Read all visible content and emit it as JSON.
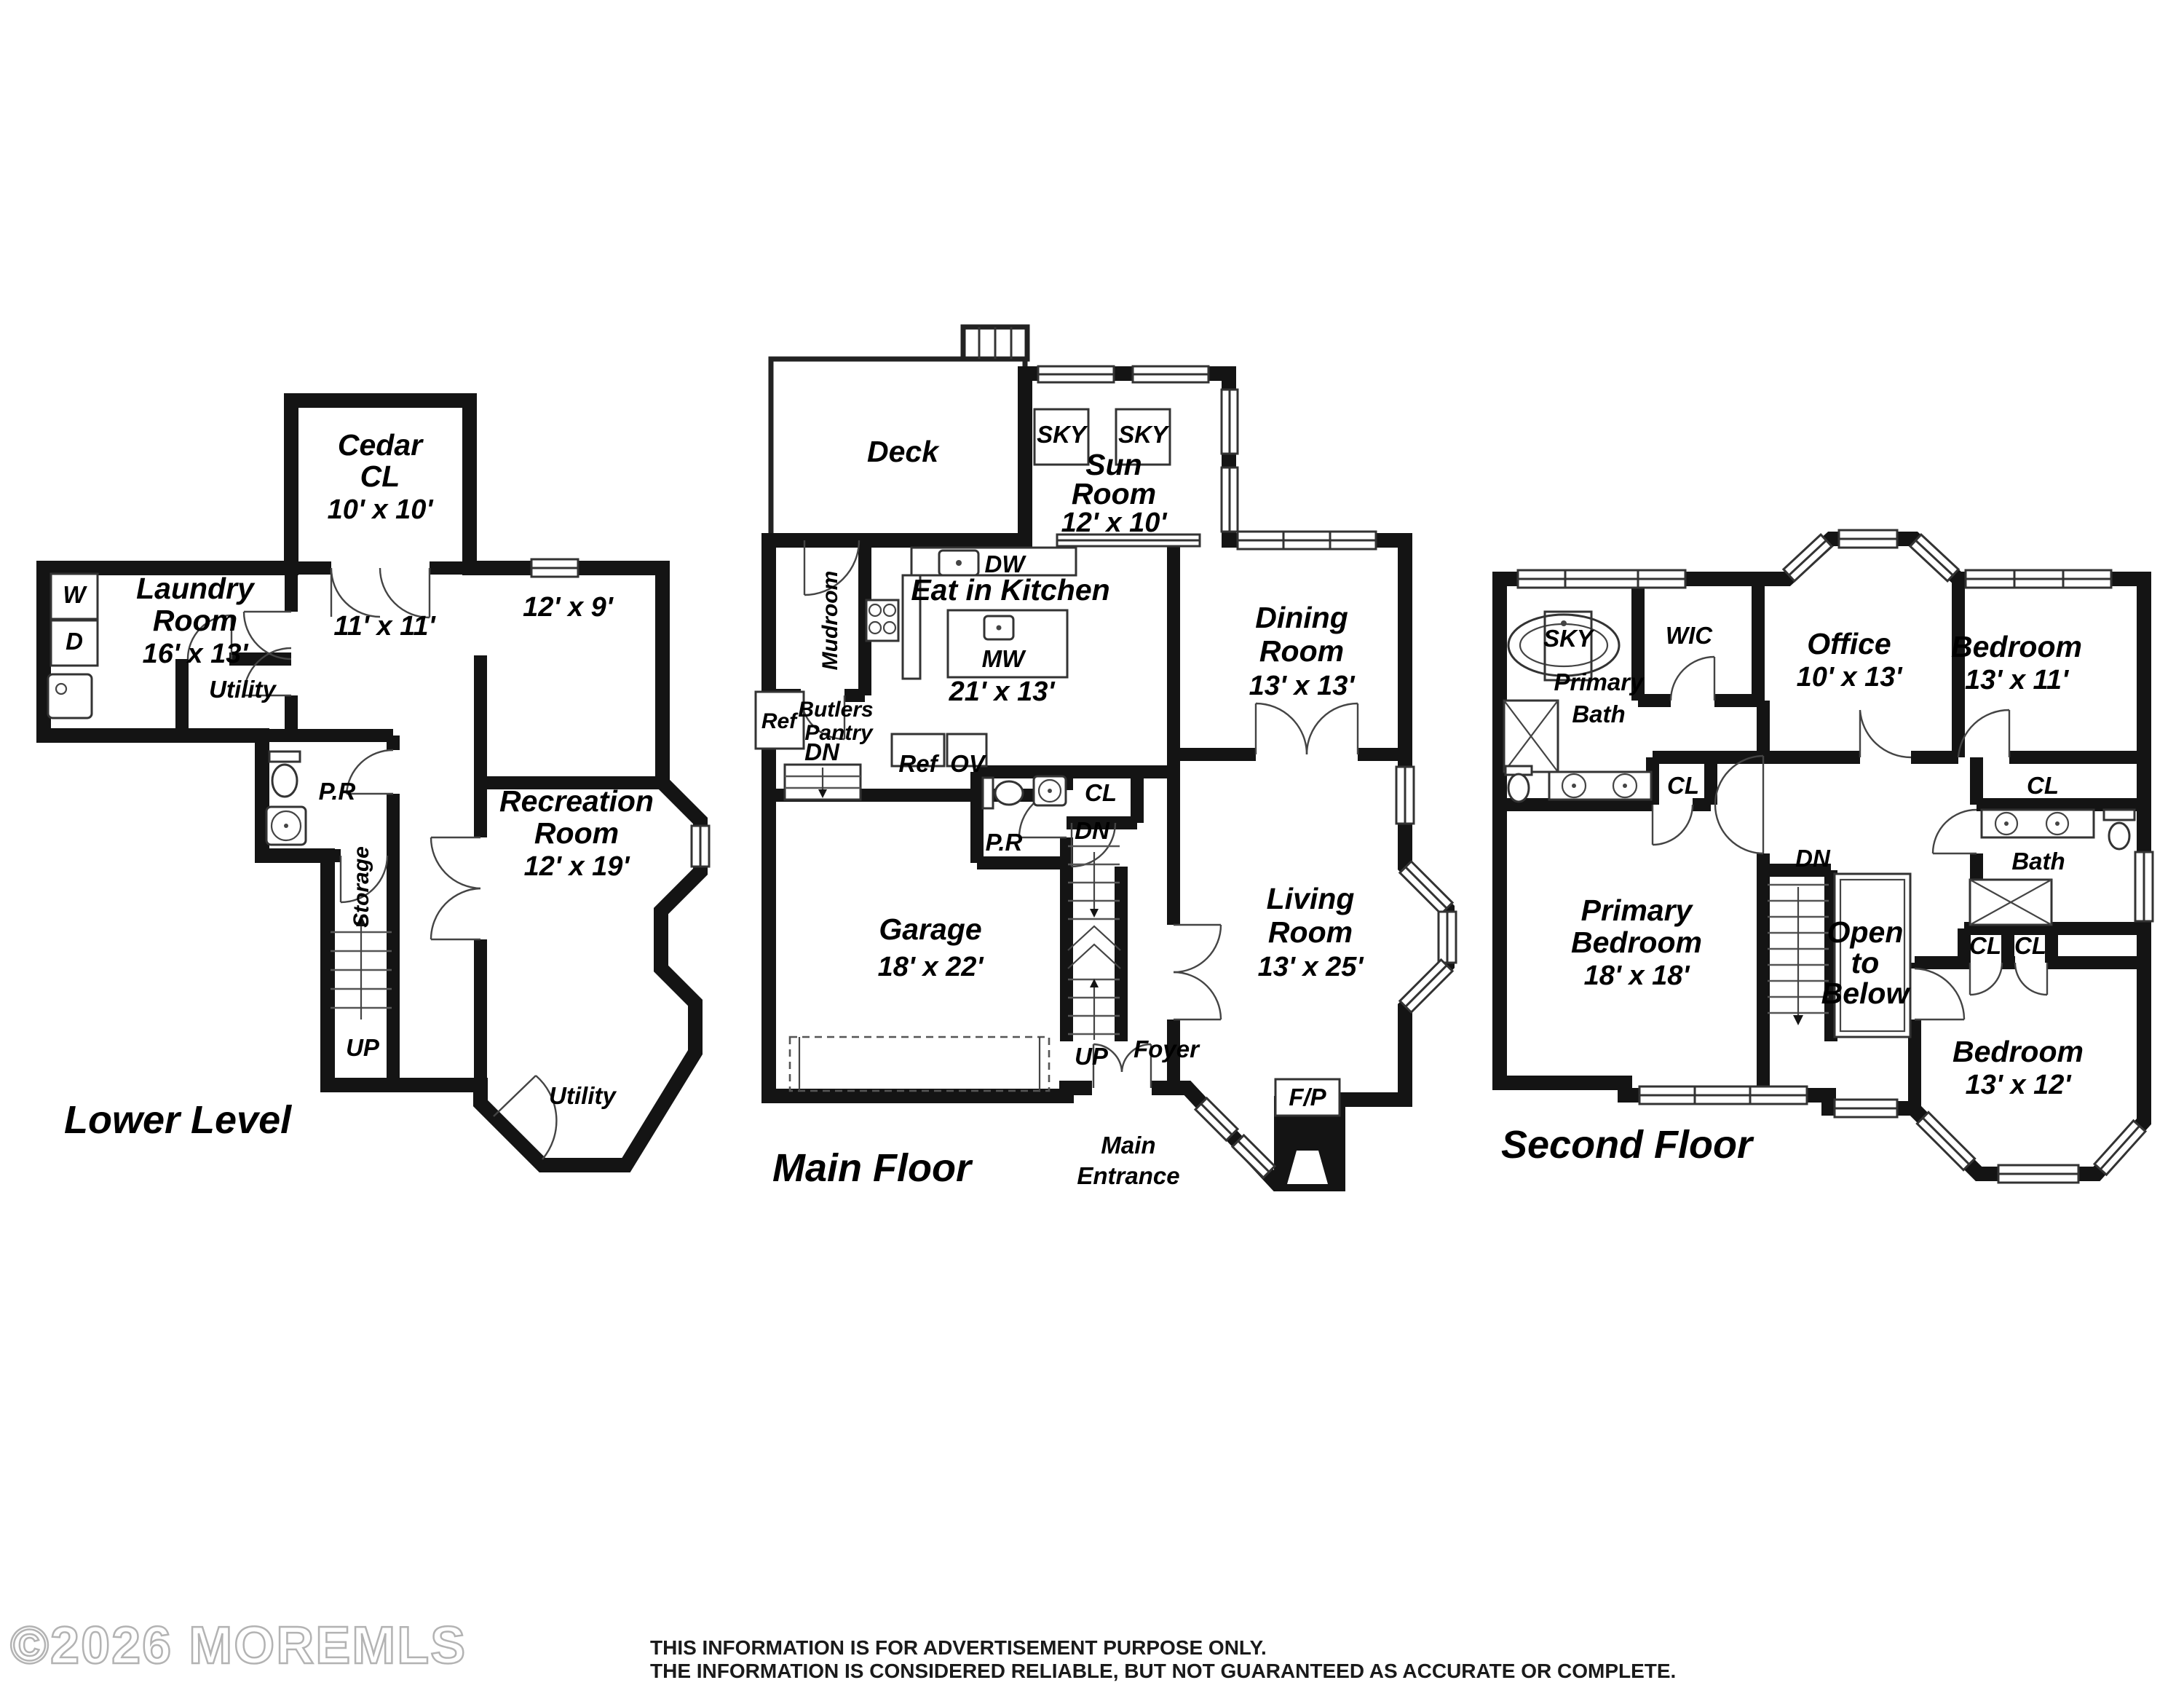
{
  "watermark": {
    "text": "©2026 MOREMLS"
  },
  "disclaimer": {
    "line1": "THIS INFORMATION IS FOR ADVERTISEMENT PURPOSE ONLY.",
    "line2": "THE INFORMATION IS CONSIDERED RELIABLE, BUT NOT GUARANTEED AS ACCURATE OR COMPLETE."
  },
  "floors": {
    "lower": {
      "title": "Lower Level",
      "cedar": {
        "l1": "Cedar",
        "l2": "CL",
        "l3": "10' x 10'"
      },
      "laundry": {
        "l1": "Laundry",
        "l2": "Room",
        "l3": "16' x 13'"
      },
      "washer": "W",
      "dryer": "D",
      "utility_upper": "Utility",
      "hall_dims": "11' x 11'",
      "room_12x9": "12' x 9'",
      "powder": "P.R",
      "storage": "Storage",
      "up": "UP",
      "recreation": {
        "l1": "Recreation",
        "l2": "Room",
        "l3": "12' x 19'"
      },
      "utility_lower": "Utility"
    },
    "main": {
      "title": "Main Floor",
      "deck": "Deck",
      "sky1": "SKY",
      "sky2": "SKY",
      "sun": {
        "l1": "Sun",
        "l2": "Room",
        "l3": "12' x 10'"
      },
      "dw": "DW",
      "kitchen_name": "Eat in Kitchen",
      "mw": "MW",
      "kitchen_dims": "21' x 13'",
      "mudroom": "Mudroom",
      "butlers": {
        "l1": "Butlers",
        "l2": "Pantry"
      },
      "ref_pantry": "Ref",
      "dn_pantry": "DN",
      "ref": "Ref",
      "ov": "OV",
      "powder": "P.R",
      "closet": "CL",
      "dn": "DN",
      "up": "UP",
      "foyer": "Foyer",
      "dining": {
        "l1": "Dining",
        "l2": "Room",
        "l3": "13' x 13'"
      },
      "living": {
        "l1": "Living",
        "l2": "Room",
        "l3": "13' x 25'"
      },
      "garage": {
        "l1": "Garage",
        "l2": "18' x 22'"
      },
      "entrance": {
        "l1": "Main",
        "l2": "Entrance"
      },
      "fireplace": "F/P"
    },
    "second": {
      "title": "Second Floor",
      "sky": "SKY",
      "primary_bath": {
        "l1": "Primary",
        "l2": "Bath"
      },
      "wic": "WIC",
      "cl_primary": "CL",
      "office": {
        "l1": "Office",
        "l2": "10' x 13'"
      },
      "bedroom1": {
        "l1": "Bedroom",
        "l2": "13' x 11'"
      },
      "cl_bed1": "CL",
      "bath2": "Bath",
      "cl_a": "CL",
      "cl_b": "CL",
      "bedroom2": {
        "l1": "Bedroom",
        "l2": "13' x 12'"
      },
      "primary_bedroom": {
        "l1": "Primary",
        "l2": "Bedroom",
        "l3": "18' x 18'"
      },
      "dn": "DN",
      "open": {
        "l1": "Open",
        "l2": "to",
        "l3": "Below"
      }
    }
  }
}
